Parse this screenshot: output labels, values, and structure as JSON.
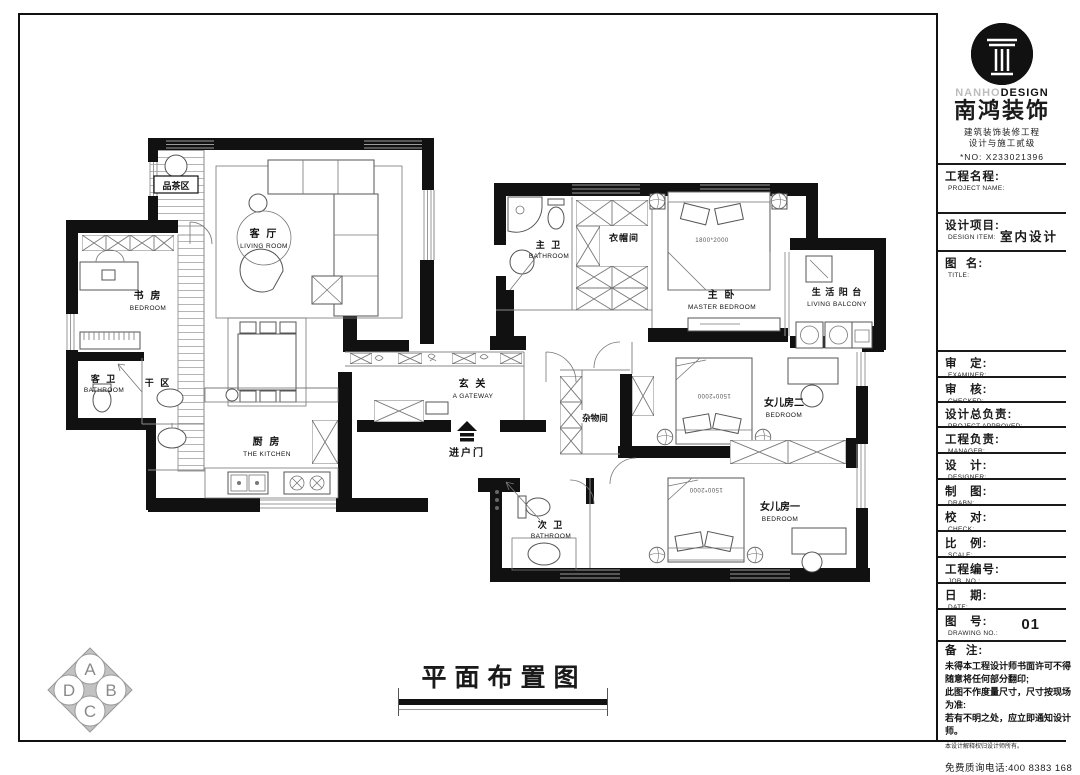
{
  "brand": {
    "name_en_light": "NANHO",
    "name_en_bold": "DESIGN",
    "name_zh": "南鸿装饰",
    "sub1": "建筑装饰装修工程",
    "sub2": "设计与施工贰级",
    "license": "*NO: X233021396"
  },
  "titleblock": {
    "fields": [
      {
        "zh": "工程名程:",
        "en": "PROJECT NAME:",
        "value": ""
      },
      {
        "zh": "设计项目:",
        "en": "DESIGN ITEM:",
        "value": "室内设计"
      },
      {
        "zh": "图  名:",
        "en": "TITLE:",
        "value": ""
      },
      {
        "zh": "审   定:",
        "en": "EXAMINER:",
        "value": ""
      },
      {
        "zh": "审   核:",
        "en": "CHECKED:",
        "value": ""
      },
      {
        "zh": "设计总负责:",
        "en": "PROJECT APPROVED:",
        "value": ""
      },
      {
        "zh": "工程负责:",
        "en": "MANAGER:",
        "value": ""
      },
      {
        "zh": "设   计:",
        "en": "DESIGNER:",
        "value": ""
      },
      {
        "zh": "制   图:",
        "en": "DRABN:",
        "value": ""
      },
      {
        "zh": "校   对:",
        "en": "CHECK:",
        "value": ""
      },
      {
        "zh": "比   例:",
        "en": "SCALE:",
        "value": ""
      },
      {
        "zh": "工程编号:",
        "en": "JOB  NO.:",
        "value": ""
      },
      {
        "zh": "日   期:",
        "en": "DATE:",
        "value": ""
      },
      {
        "zh": "图   号:",
        "en": "DRAWING NO.:",
        "value": "01"
      }
    ],
    "notes": {
      "zh": "备  注:",
      "lines": [
        "未得本工程设计师书面许可不得",
        "随意将任何部分翻印;",
        "此图不作度量尺寸，尺寸按现场",
        "为准:",
        "若有不明之处，应立即通知设计",
        "师。"
      ],
      "fine_print": "本设计解释权归设计师所有。",
      "hotline": "免费质询电话:400 8383 168"
    }
  },
  "plan": {
    "title": "平面布置图",
    "rooms": [
      {
        "zh": "品茶区",
        "en": ""
      },
      {
        "zh": "客 厅",
        "en": "LIVING ROOM"
      },
      {
        "zh": "书 房",
        "en": "BEDROOM"
      },
      {
        "zh": "客 卫",
        "en": "BATHROOM"
      },
      {
        "zh": "干 区",
        "en": ""
      },
      {
        "zh": "厨 房",
        "en": "THE KITCHEN"
      },
      {
        "zh": "玄 关",
        "en": "A GATEWAY"
      },
      {
        "zh": "进户门",
        "en": ""
      },
      {
        "zh": "主 卫",
        "en": "BATHROOM"
      },
      {
        "zh": "衣帽间",
        "en": ""
      },
      {
        "zh": "主 卧",
        "en": "MASTER BEDROOM"
      },
      {
        "zh": "生 活 阳 台",
        "en": "LIVING BALCONY"
      },
      {
        "zh": "杂物间",
        "en": ""
      },
      {
        "zh": "女儿房二",
        "en": "BEDROOM"
      },
      {
        "zh": "女儿房一",
        "en": "BEDROOM"
      },
      {
        "zh": "次 卫",
        "en": "BATHROOM"
      }
    ],
    "beds": [
      "1800*2000",
      "1500*2000",
      "1500*2000"
    ]
  },
  "compass": {
    "letters": [
      "A",
      "B",
      "C",
      "D"
    ]
  }
}
